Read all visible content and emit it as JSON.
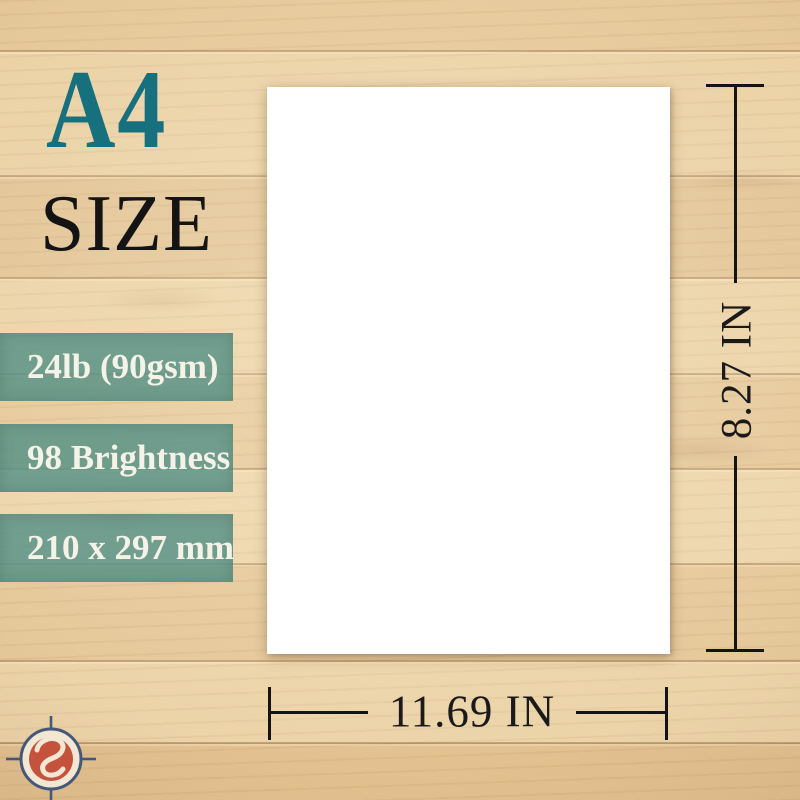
{
  "header": {
    "size_code": "A4",
    "size_word": "SIZE"
  },
  "specs": {
    "items": [
      {
        "label": "24lb (90gsm)"
      },
      {
        "label": "98 Brightness"
      },
      {
        "label": "210 x 297 mm"
      }
    ]
  },
  "dimensions": {
    "height_label": "8.27 IN",
    "width_label": "11.69 IN"
  },
  "branding": {
    "logo_icon": "s-crosshair-logo"
  },
  "colors": {
    "accent_teal": "#17707e",
    "banner_teal": "#58928-8",
    "wood_base": "#e9cfa3",
    "logo_red": "#c4523c",
    "logo_ring": "#46587a",
    "dimension_line": "#141414"
  }
}
